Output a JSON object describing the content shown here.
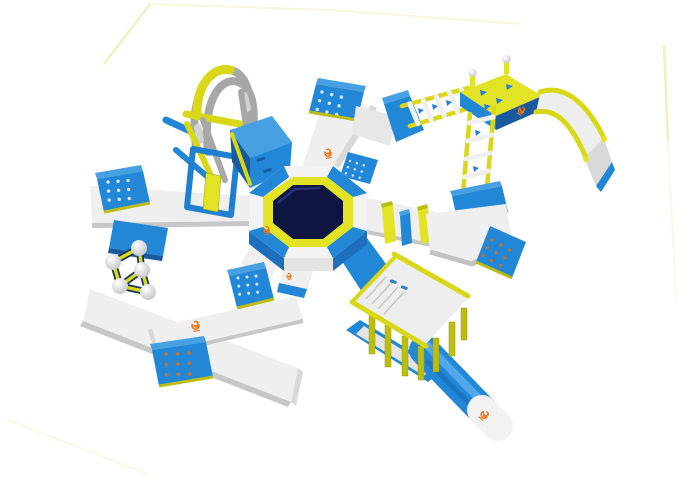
{
  "scene": {
    "type": "3d-product-render",
    "subject": "inflatable-floating-water-park",
    "aria_label": "3D render of a blue, white and yellow inflatable floating water park obstacle course on a white background",
    "background": "#ffffff",
    "components": [
      "central-water-trampoline",
      "north-walkway",
      "northeast-ladder-bridge",
      "slide-tower",
      "water-slide",
      "vertical-ladder",
      "east-walkway",
      "balance-fins",
      "east-landing-platform",
      "canopy-bridge",
      "blast-runway",
      "climbing-arch",
      "climbing-wedge",
      "hurdle-gate",
      "west-walkway",
      "stepping-spheres",
      "southwest-walkway-loop",
      "dotted-landing-mats",
      "brand-marks"
    ]
  },
  "palette": {
    "blue": "#2287d7",
    "blue_top": "#46a0e2",
    "blue_mid": "#1d6fbd",
    "blue_deep": "#185a9d",
    "walkway_top": "#efefef",
    "walkway_side": "#d9d9d9",
    "walkway_edge": "#c7c7c7",
    "yellow": "#e3e326",
    "yellow_dark": "#bcbc12",
    "tube_gray": "#a7a7a7",
    "trampoline_navy": "#0e1540",
    "mat_dot_light": "#d6e7f6",
    "mat_dot_tan": "#b5743f",
    "brand_orange": "#e8791e",
    "backdrop_line": "#f2efc0"
  },
  "brand_mark": {
    "color": "#e8791e",
    "count": 6,
    "positions_px": [
      [
        327,
        156
      ],
      [
        267,
        233
      ],
      [
        289,
        279
      ],
      [
        194,
        327
      ],
      [
        524,
        110
      ],
      [
        489,
        414
      ]
    ]
  },
  "trampoline": {
    "mat_color": "#0e1540",
    "ring_color": "#e3e326"
  },
  "mats": {
    "dot_grid": "3x3"
  }
}
